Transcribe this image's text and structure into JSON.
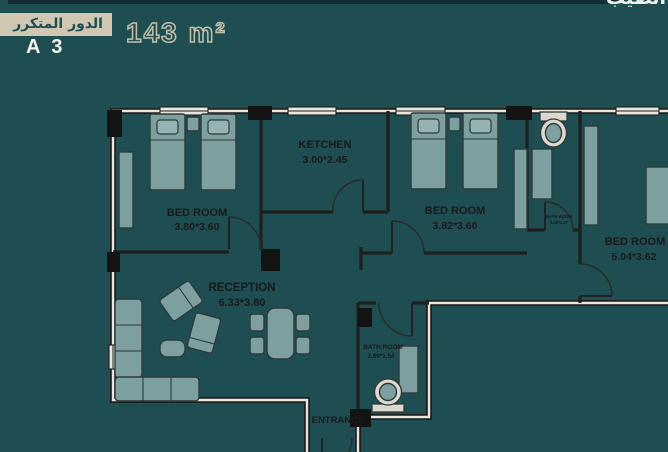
{
  "header": {
    "floor_banner": "الدور المتكرر",
    "unit_code": "A 3",
    "area": "143 m²",
    "watermark": "الطيب"
  },
  "rooms": [
    {
      "id": "bedroom-left",
      "name": "BED ROOM",
      "dims": "3.80*3.60"
    },
    {
      "id": "kitchen",
      "name": "KETCHEN",
      "dims": "3.00*2.45"
    },
    {
      "id": "bedroom-middle",
      "name": "BED ROOM",
      "dims": "3.82*3.60"
    },
    {
      "id": "bathroom-top",
      "name": "BATH ROOM",
      "dims": "3.00*1.27"
    },
    {
      "id": "bedroom-right",
      "name": "BED ROOM",
      "dims": "5.04*3.62"
    },
    {
      "id": "reception",
      "name": "RECEPTION",
      "dims": "6.33*3.80"
    },
    {
      "id": "bathroom-bottom",
      "name": "BATH ROOM",
      "dims": "2.69*1.54"
    },
    {
      "id": "entrance",
      "name": "ENTRANCE",
      "dims": ""
    }
  ],
  "colors": {
    "background": "#1e4d52",
    "banner": "#d0c7b3",
    "banner_text": "#1e4d52",
    "area_outline": "#c3c0a9",
    "room_fill": "#e9e6e0",
    "wall": "#1f1f1f",
    "furniture": "#7e9fa0",
    "furniture_light": "#95b3b3"
  }
}
